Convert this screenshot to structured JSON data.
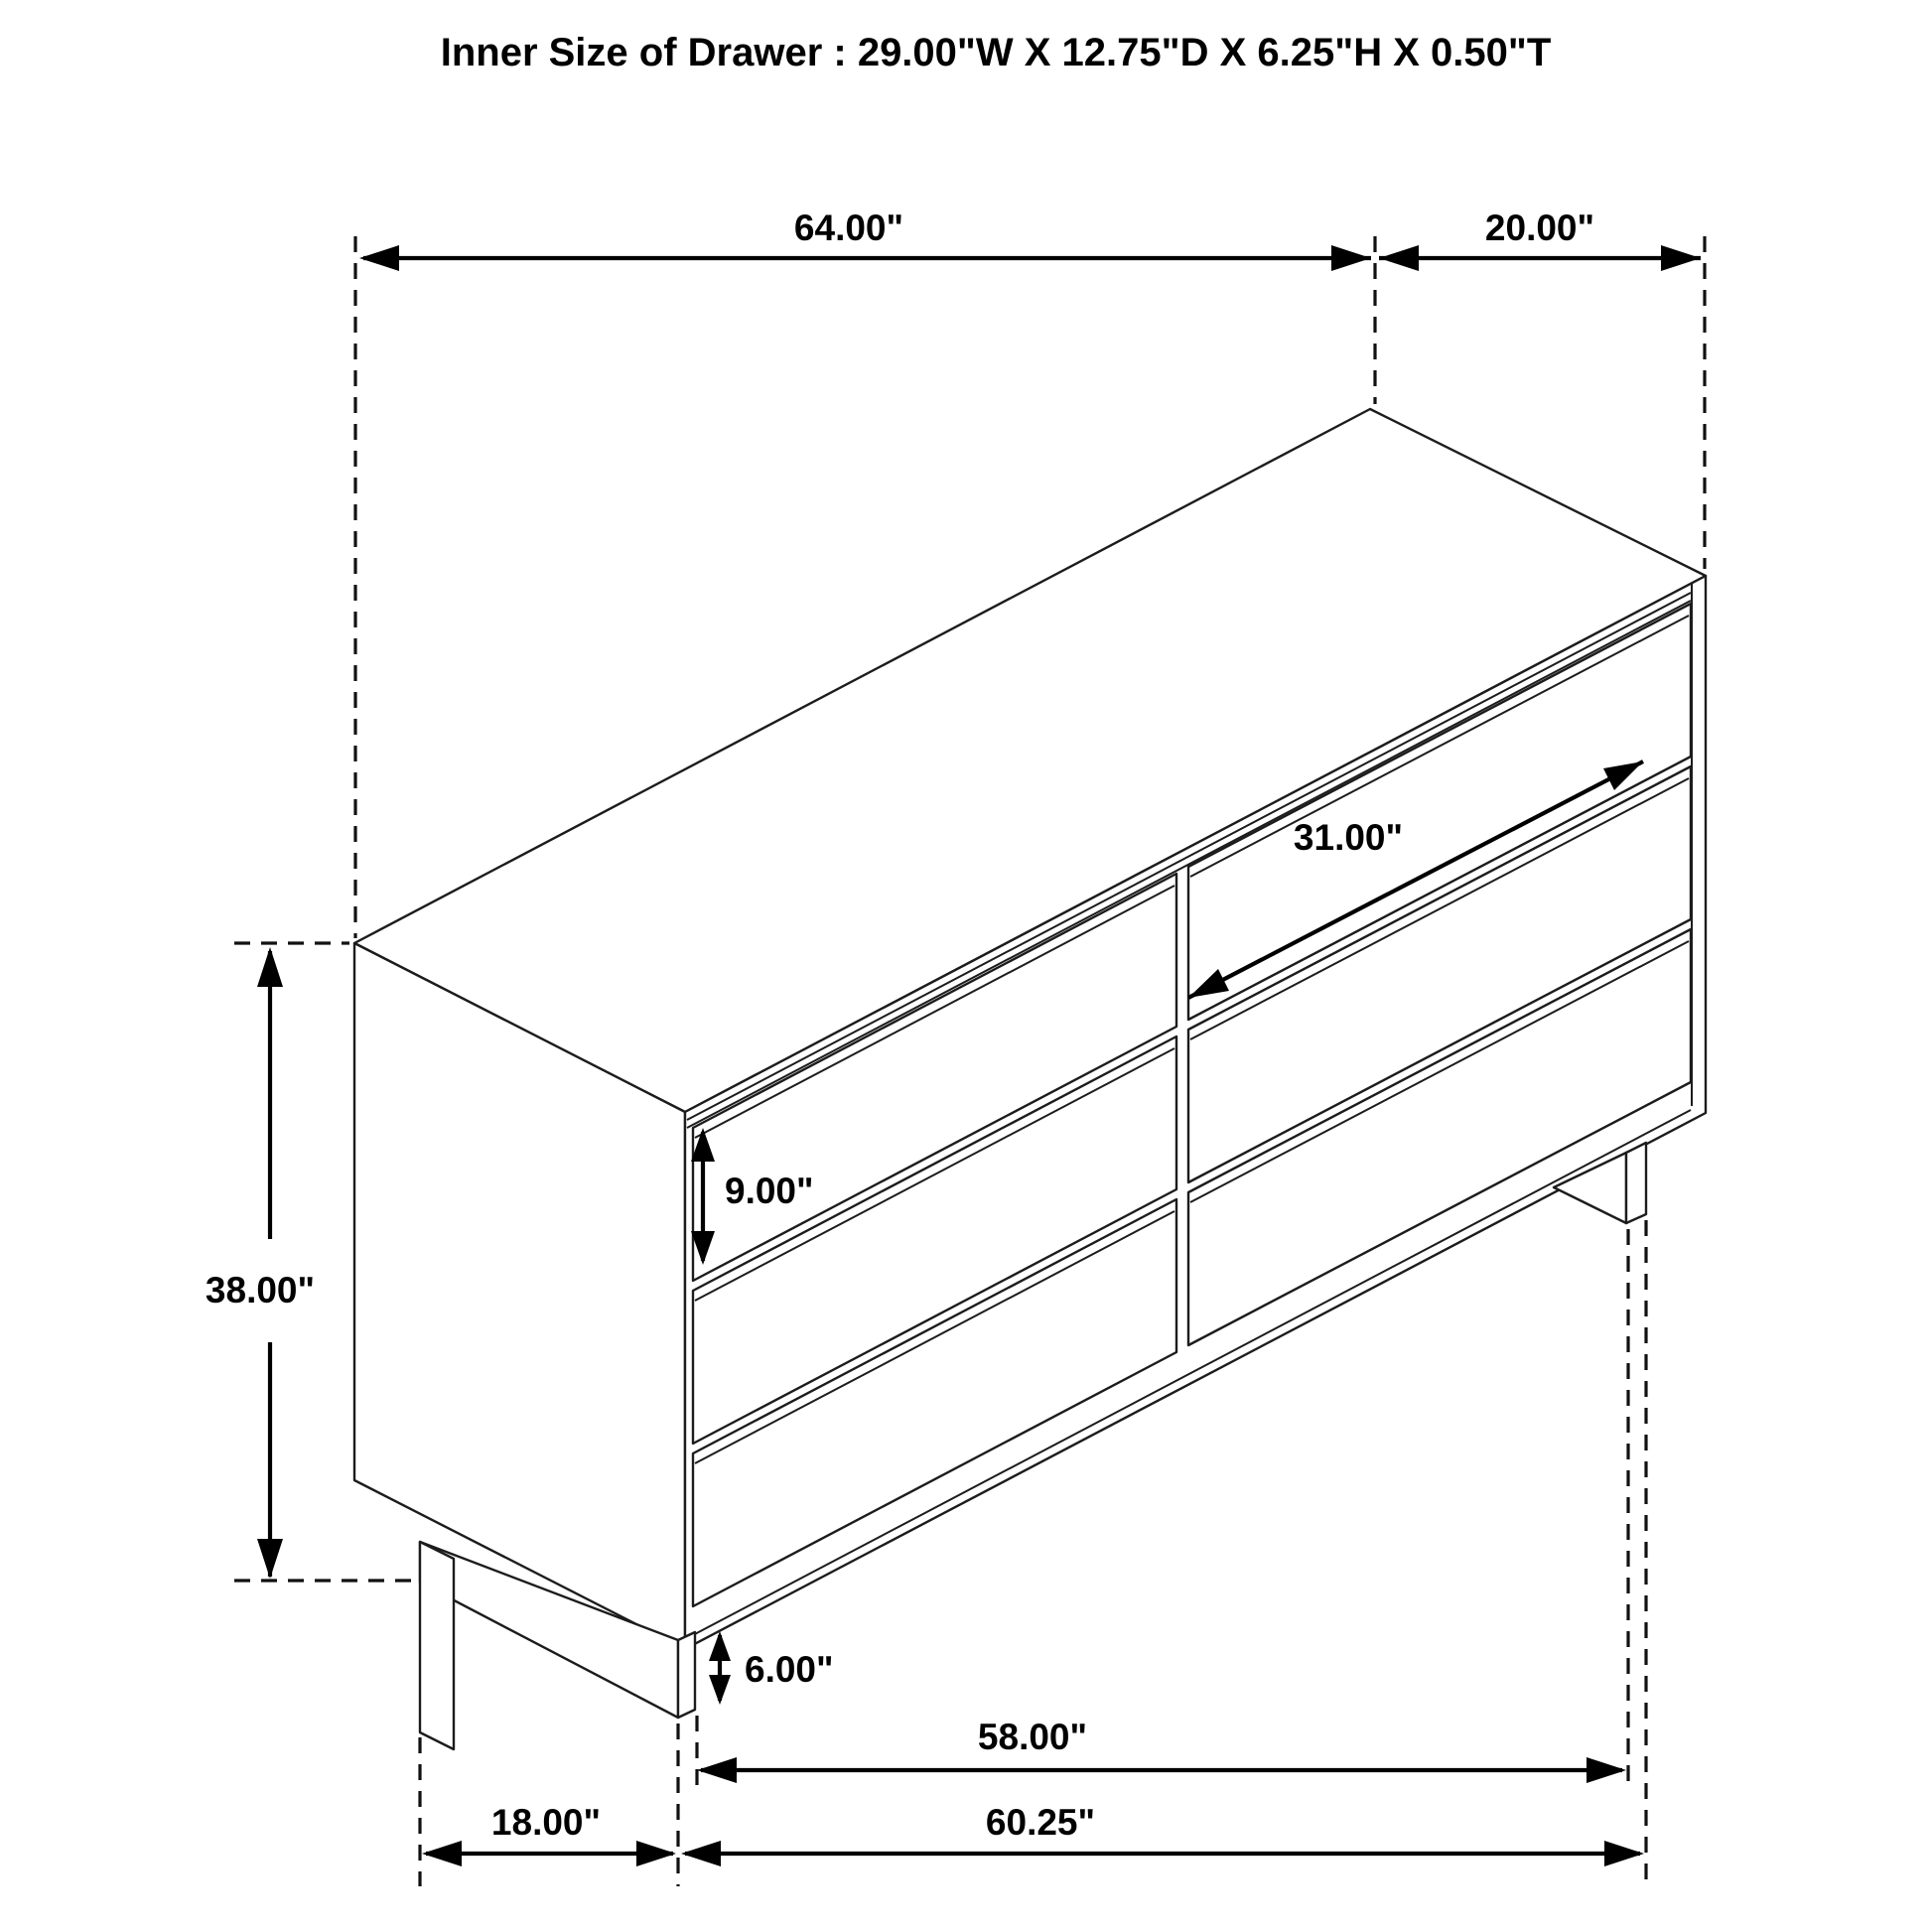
{
  "title": "Inner Size of Drawer : 29.00\"W X 12.75\"D X 6.25\"H X 0.50\"T",
  "drawing": {
    "subject": "6-drawer dresser isometric dimension diagram",
    "drawer_count": 6,
    "line_color": "#000000",
    "background_color": "#ffffff"
  },
  "dimensions": {
    "top_width": "64.00\"",
    "top_depth": "20.00\"",
    "overall_height": "38.00\"",
    "drawer_front_width": "31.00\"",
    "drawer_front_height": "9.00\"",
    "base_height": "6.00\"",
    "inner_leg_span": "58.00\"",
    "outer_base_width": "60.25\"",
    "side_leg_setback": "18.00\""
  }
}
